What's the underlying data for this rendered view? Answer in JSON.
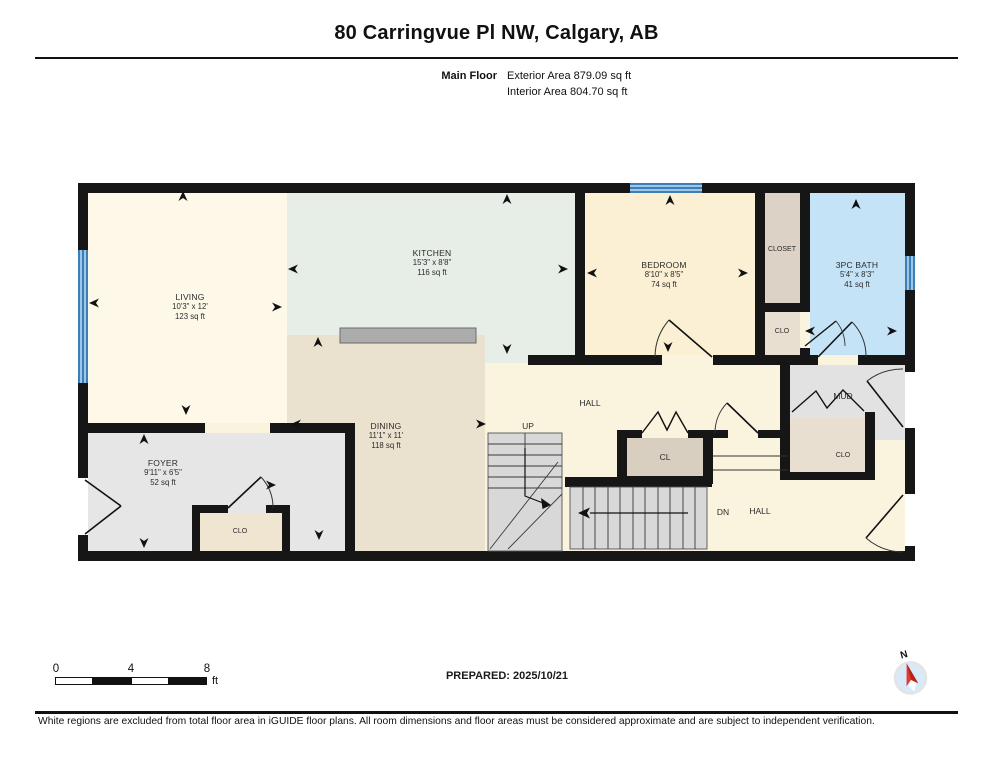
{
  "header": {
    "title": "80 Carringvue Pl NW, Calgary, AB",
    "floor_label": "Main Floor",
    "exterior_area": "Exterior Area 879.09 sq ft",
    "interior_area": "Interior Area 804.70 sq ft"
  },
  "rooms": {
    "living": {
      "name": "LIVING",
      "dims": "10'3\" x 12'",
      "area": "123 sq ft"
    },
    "kitchen": {
      "name": "KITCHEN",
      "dims": "15'3\" x 8'8\"",
      "area": "116 sq ft"
    },
    "dining": {
      "name": "DINING",
      "dims": "11'1\" x 11'",
      "area": "118 sq ft"
    },
    "bedroom": {
      "name": "BEDROOM",
      "dims": "8'10\" x 8'5\"",
      "area": "74 sq ft"
    },
    "bath": {
      "name": "3PC BATH",
      "dims": "5'4\" x 8'3\"",
      "area": "41 sq ft"
    },
    "foyer": {
      "name": "FOYER",
      "dims": "9'11\" x 6'5\"",
      "area": "52 sq ft"
    }
  },
  "labels": {
    "hall_upper": "HALL",
    "hall_lower": "HALL",
    "up": "UP",
    "dn": "DN",
    "cl": "CL",
    "closet": "CLOSET",
    "clo_bedroom": "CLO",
    "clo_mud": "CLO",
    "clo_foyer": "CLO",
    "mud": "MUD",
    "compass_north": "N"
  },
  "scale_bar": {
    "tick_0": "0",
    "tick_4": "4",
    "tick_8": "8",
    "unit": "ft"
  },
  "footer": {
    "prepared": "PREPARED: 2025/10/21",
    "disclaimer": "White regions are excluded from total floor area in iGUIDE floor plans. All room dimensions and floor areas must be considered approximate and are subject to independent verification."
  },
  "colors": {
    "wall": "#161616",
    "hall": "#FAF4DE",
    "living": "#FDF8E8",
    "kitchen": "#E7EEE8",
    "dining": "#EAE2CF",
    "bedroom": "#FBF0D4",
    "bath": "#C5E3F6",
    "foyer": "#E6E6E6",
    "mud": "#E2E2E2",
    "closet_tan": "#DCD3C6",
    "clo_tan": "#E9DFD0",
    "cl_tan": "#D9CFC0",
    "clo_foyer_tan": "#EFE5D0",
    "stairs": "#D8D8D8",
    "counter": "#ACACAC",
    "window_blue": "#4E97CB",
    "compass_needle": "#E03C31",
    "compass_face": "#D8E9F8"
  }
}
